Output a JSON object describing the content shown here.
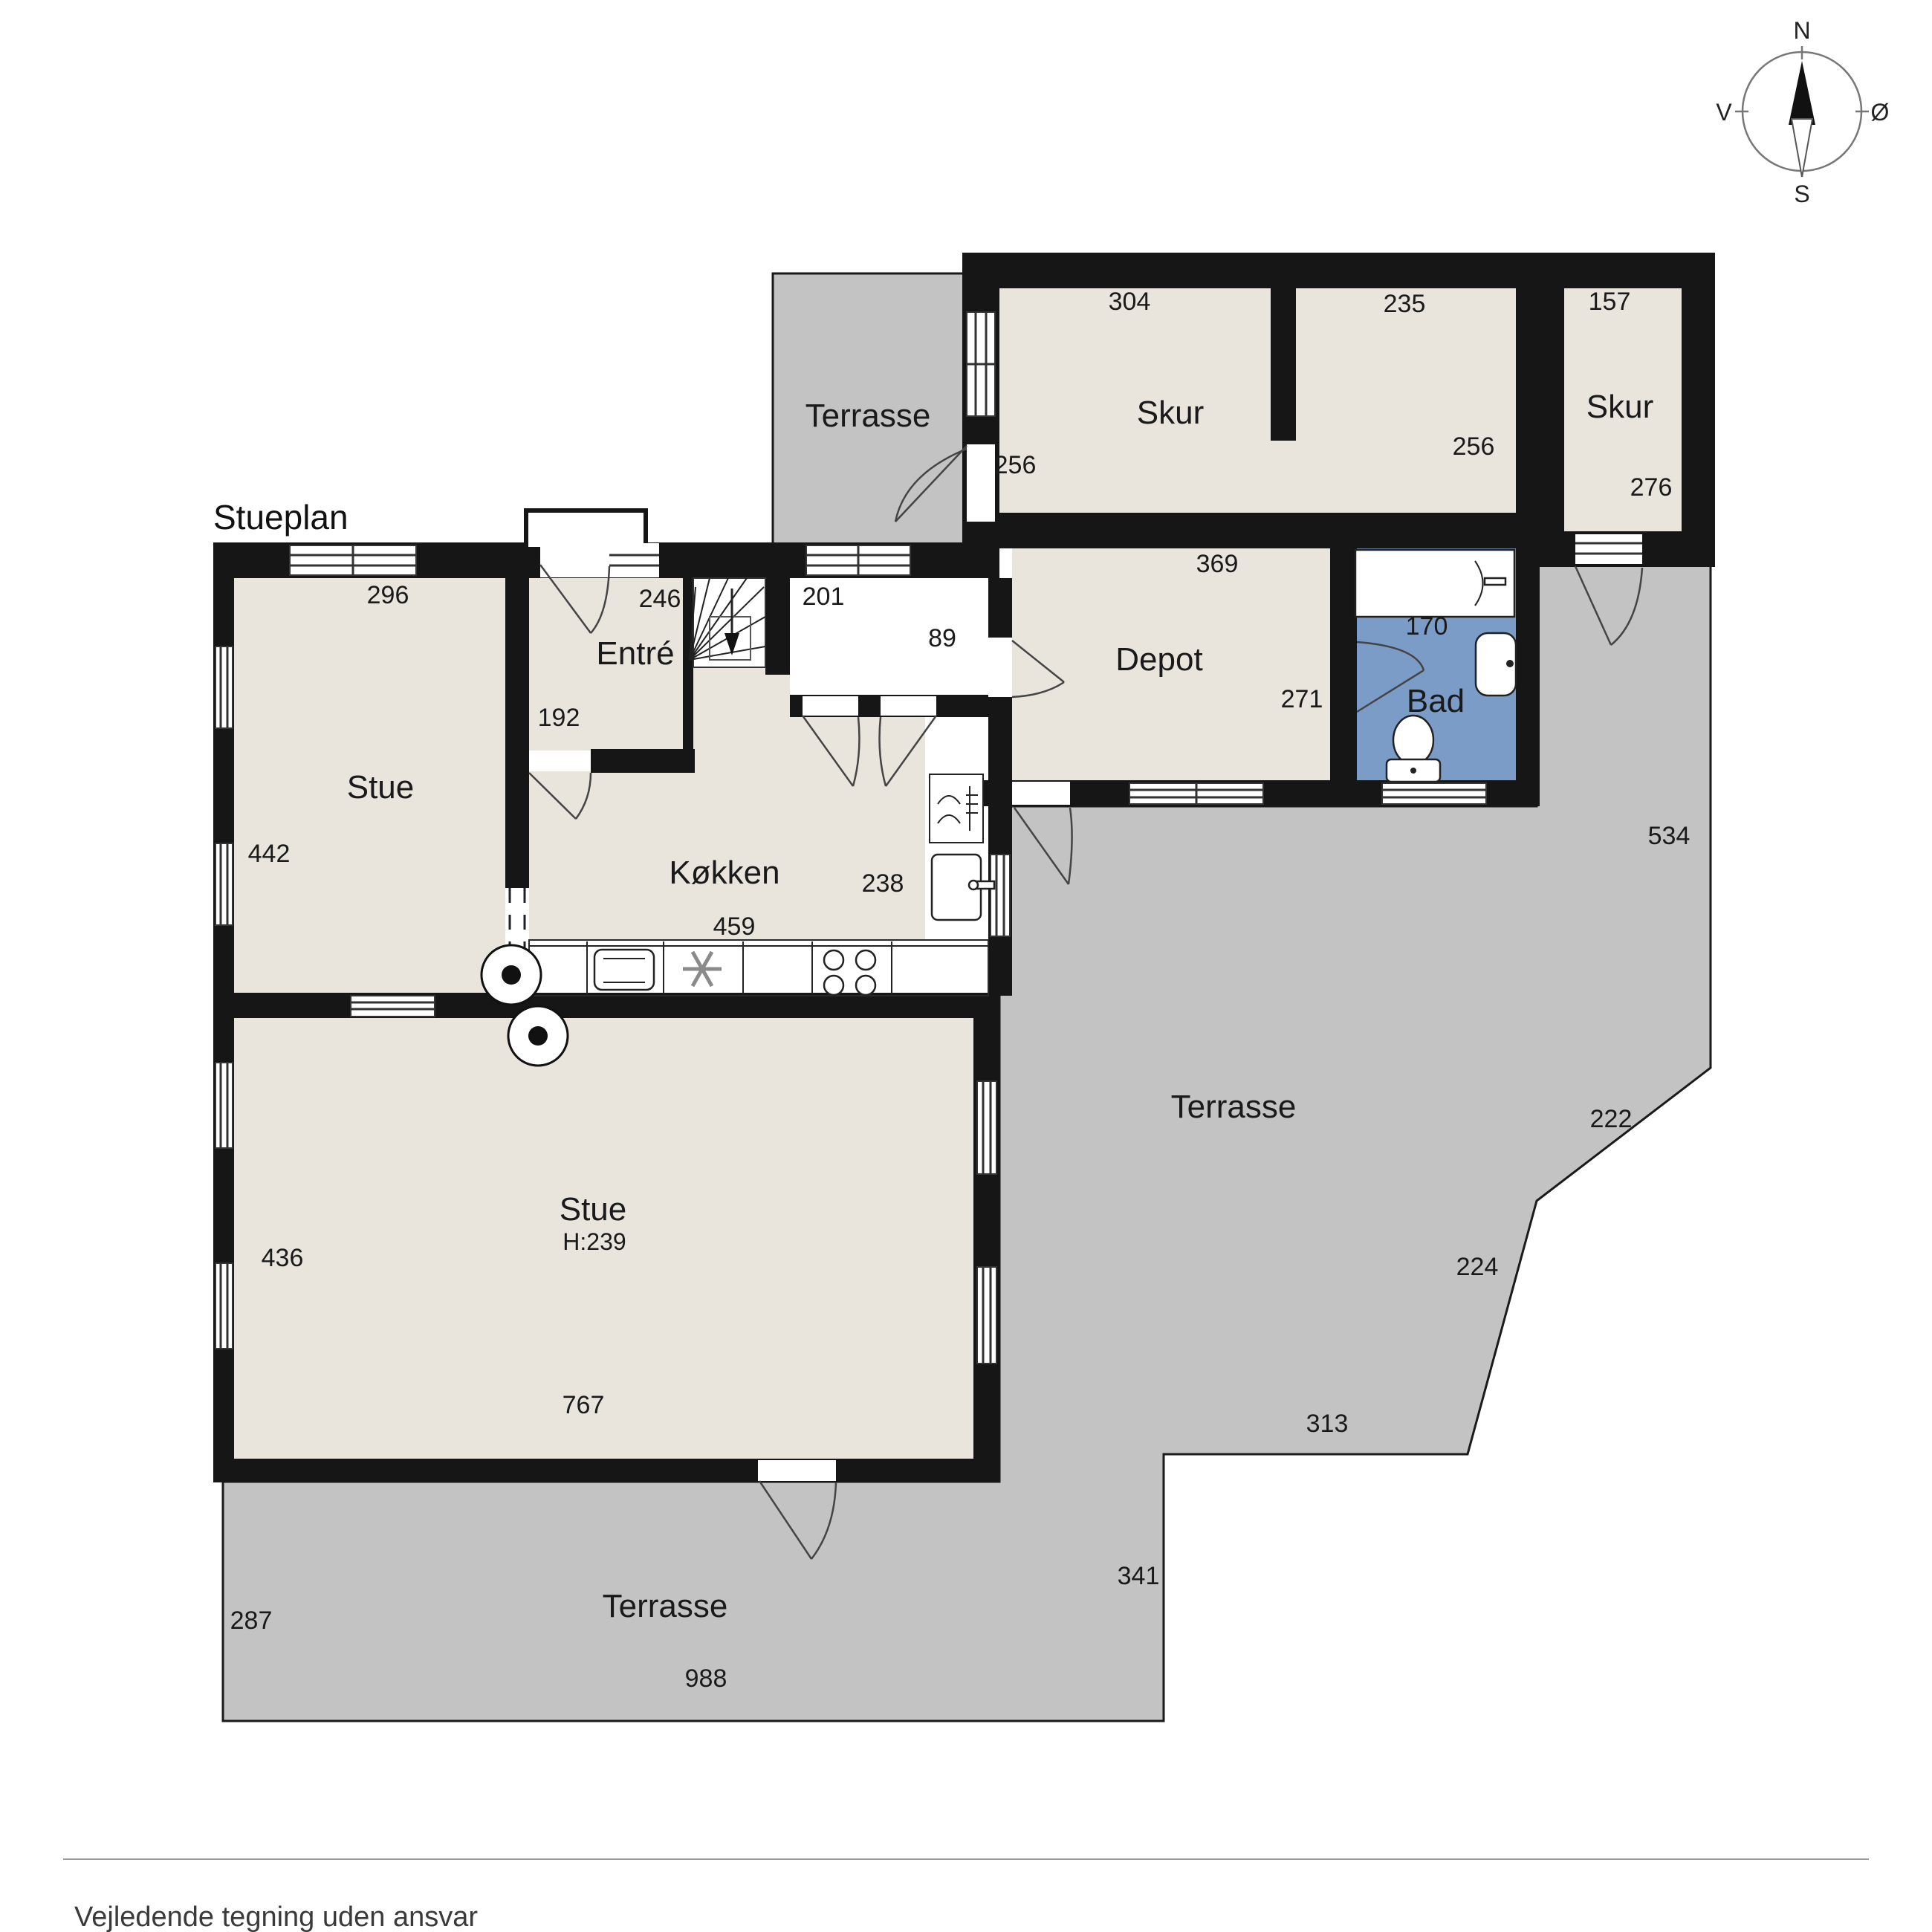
{
  "header": {
    "title": "Stueplan"
  },
  "footer": {
    "disclaimer": "Vejledende tegning uden ansvar"
  },
  "compass": {
    "north": "N",
    "east": "Ø",
    "south": "S",
    "west": "V"
  },
  "colors": {
    "wall": "#161616",
    "room_fill": "#e9e4dc",
    "terrace_fill": "#c3c3c3",
    "bath_fill": "#7b9cc7",
    "paper": "#ffffff"
  },
  "rooms": {
    "skur_main": {
      "label": "Skur",
      "dim_top_left": "304",
      "dim_top_right": "235",
      "dim_bottom_left": "256",
      "dim_bottom_right": "256"
    },
    "skur_small": {
      "label": "Skur",
      "dim_top": "157",
      "dim_bottom": "276"
    },
    "terrasse_top": {
      "label": "Terrasse"
    },
    "depot": {
      "label": "Depot",
      "dim_top": "369",
      "dim_right": "271"
    },
    "bad": {
      "label": "Bad",
      "dim_top": "170"
    },
    "hall": {
      "dim_top": "201",
      "dim_right": "89"
    },
    "entre": {
      "label": "Entré",
      "dim_top": "246",
      "dim_left": "192"
    },
    "stue_top": {
      "label": "Stue",
      "dim_top": "296",
      "dim_left": "442"
    },
    "kokken": {
      "label": "Køkken",
      "dim_right": "238",
      "dim_bottom": "459"
    },
    "stue_main": {
      "label": "Stue",
      "ceiling_height": "H:239",
      "dim_left": "436",
      "dim_bottom": "767"
    },
    "terrasse_right": {
      "label": "Terrasse",
      "dim_right": "534",
      "dim_diagonal_upper": "222",
      "dim_diagonal_lower": "224",
      "dim_bottom": "313",
      "dim_left": "341"
    },
    "terrasse_bottom": {
      "label": "Terrasse",
      "dim_left": "287",
      "dim_bottom": "988"
    }
  }
}
